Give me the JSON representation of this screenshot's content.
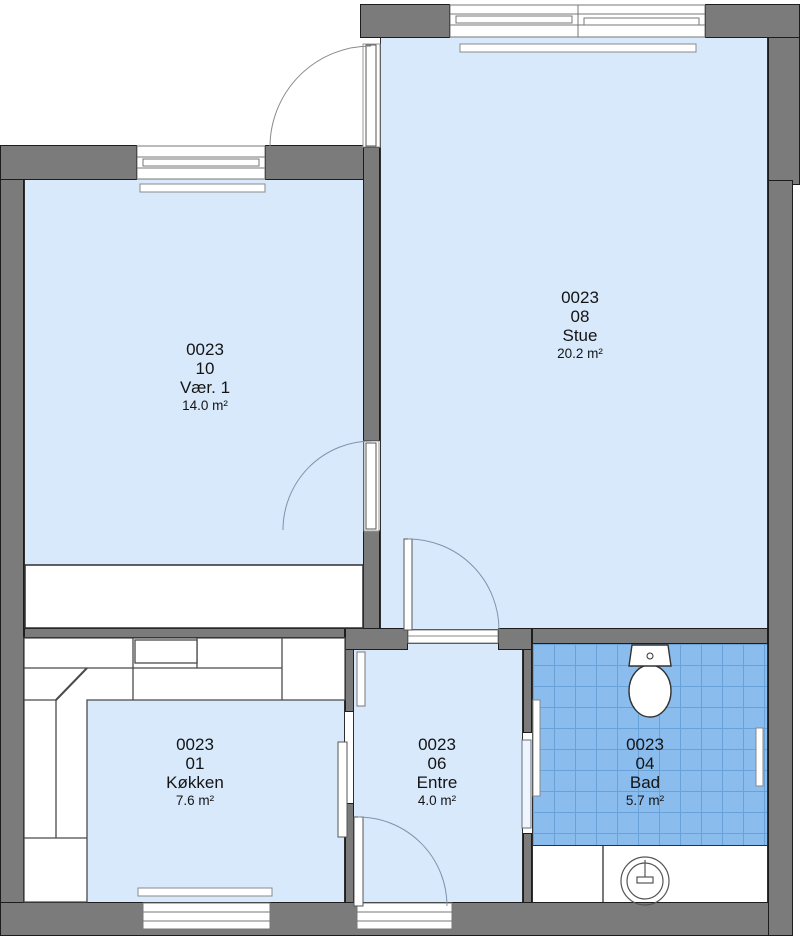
{
  "plan": {
    "title": "Apartment floor plan 0023",
    "rooms": [
      {
        "id": "vaer1",
        "code": "0023",
        "number": "10",
        "name": "Vær. 1",
        "area": "14.0 m²"
      },
      {
        "id": "stue",
        "code": "0023",
        "number": "08",
        "name": "Stue",
        "area": "20.2 m²"
      },
      {
        "id": "koekken",
        "code": "0023",
        "number": "01",
        "name": "Køkken",
        "area": "7.6 m²"
      },
      {
        "id": "entre",
        "code": "0023",
        "number": "06",
        "name": "Entre",
        "area": "4.0 m²"
      },
      {
        "id": "bad",
        "code": "0023",
        "number": "04",
        "name": "Bad",
        "area": "5.7 m²"
      }
    ],
    "fixtures": [
      "toilet",
      "washbasin",
      "wardrobe",
      "kitchen-counter",
      "radiators"
    ],
    "colors": {
      "wall": "#7b7b7b",
      "wall_outline": "#1d1d1d",
      "floor": "#d9e9fc",
      "bath_tile": "#8abcee",
      "bath_tile_line": "#69a2d8",
      "door_arc": "#7d93aa",
      "label_text": "#141414"
    }
  }
}
